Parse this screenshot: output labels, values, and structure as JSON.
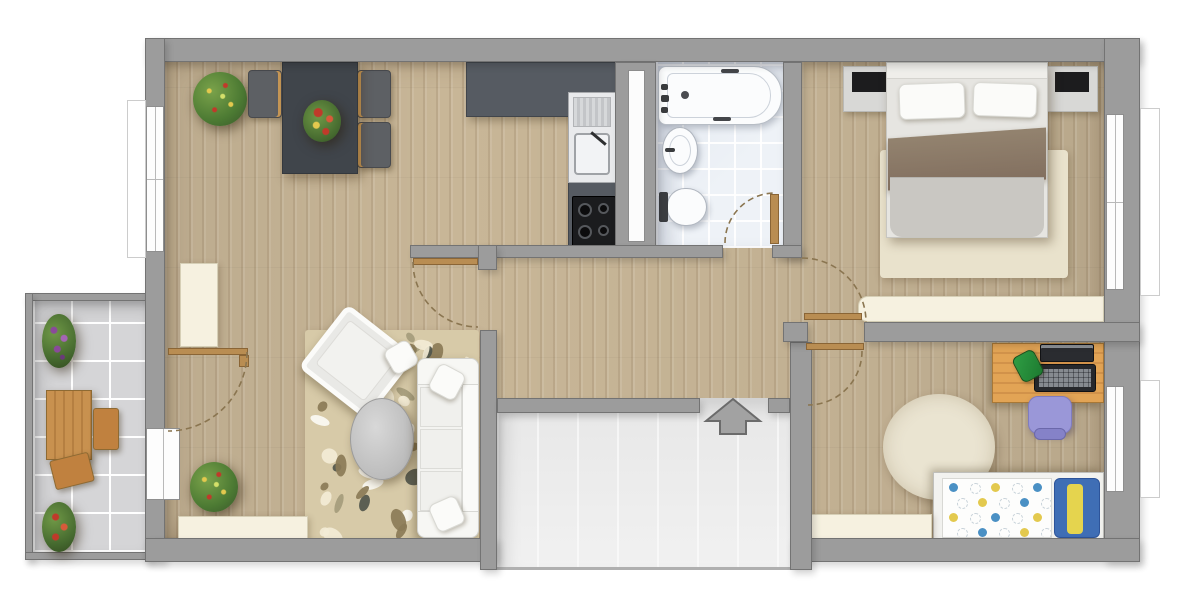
{
  "plan": {
    "kind": "apartment floor plan, top-down rendered, no text labels",
    "canvas": {
      "width": 1200,
      "height": 600
    }
  },
  "colors": {
    "background": "#ffffff",
    "wall": "#9c9c9c",
    "wall_edge": "#737373",
    "wood_floor": "#c8b697",
    "bath_tile": "#eef2f7",
    "balcony_tile": "#d5d5d7",
    "niche_floor": "#ececec",
    "door_leaf": "#b98d52",
    "dining_table": "#40454b",
    "chair": "#5d6064",
    "chair_wood_trim": "#c99a58",
    "kitchen_counter": "#565b62",
    "cooktop": "#1b1c1e",
    "sink_unit": "#e9eaec",
    "rug_living": "#d7caa8",
    "rug_bedroom": "#e9e2cc",
    "rug_kids": "#eae4d1",
    "radiator": "#f6f1e0",
    "bed_frame": "#e6e5e1",
    "bed_blanket": "#8b7b6d",
    "bed_duvet": "#c9c7c2",
    "nightstand": "#d8d8d6",
    "lamp": "#1c1c1e",
    "sofa": "#f3f3f0",
    "coffee_table": "#c7c7c7",
    "kids_desk": "#dc9f52",
    "kids_chair": "#9a97d8",
    "kids_pillow": "#3f6eb5",
    "kids_pillow_stripe": "#e5d44e",
    "toilet_tank": "#3b3d41",
    "arrow": "#a2a2a2",
    "balcony_wood": "#c28a4e",
    "plant_green": "#4c7a33",
    "flower_red": "#c03a2a",
    "flower_purple": "#8a4a9a",
    "flower_yellow": "#e3c94e"
  },
  "rooms": [
    {
      "name": "dining-kitchen",
      "floor": "wood",
      "items": [
        "potted-plant",
        "dining-table",
        "chair x3",
        "flower-centerpiece",
        "radiator",
        "kitchen-counter",
        "kitchen-sink",
        "cooktop"
      ]
    },
    {
      "name": "bathroom",
      "floor": "tile",
      "items": [
        "bathtub",
        "washbasin",
        "toilet",
        "door"
      ]
    },
    {
      "name": "bedroom",
      "floor": "wood",
      "items": [
        "double-bed",
        "pillow x2",
        "blanket",
        "nightstand x2",
        "lamp x2",
        "rug",
        "sideboard",
        "window",
        "door"
      ]
    },
    {
      "name": "living-room",
      "floor": "wood",
      "items": [
        "area-rug",
        "armchair",
        "sofa",
        "coffee-table",
        "potted-plant",
        "radiator",
        "balcony-door",
        "door"
      ]
    },
    {
      "name": "kids-room",
      "floor": "wood",
      "items": [
        "desk",
        "laptop",
        "keyboard",
        "pencil-cup",
        "desk-chair",
        "round-rug",
        "single-bed",
        "polka-dot-duvet",
        "pillow",
        "radiator",
        "window",
        "door"
      ]
    },
    {
      "name": "hallway",
      "floor": "wood",
      "items": []
    },
    {
      "name": "balcony",
      "floor": "tile",
      "items": [
        "wood-table",
        "wood-chair x2",
        "flower-pot x2"
      ]
    },
    {
      "name": "entrance",
      "items": [
        "entry-arrow"
      ]
    }
  ],
  "openings": {
    "windows": [
      "dining-left",
      "balcony-door-left",
      "bedroom-right",
      "kids-room-right"
    ],
    "door_arcs": [
      "dining",
      "living",
      "bathroom",
      "bedroom",
      "kids-room"
    ],
    "entrance_symbol": "arrow-up"
  },
  "living_rug": {
    "spot_count": 46,
    "spot_colors": [
      "#f3ecd6",
      "#51564c",
      "#8b7b57",
      "#a59c7c",
      "#fbfaf4"
    ],
    "seed": 7
  },
  "kids_bed": {
    "dot_rows": 4,
    "dot_cols": 5,
    "dot_colors": [
      "#4a90c4",
      "#9ab23c",
      "#e3c94e",
      "#2e7d32"
    ],
    "outline_dot_color": "#c9d3da"
  }
}
